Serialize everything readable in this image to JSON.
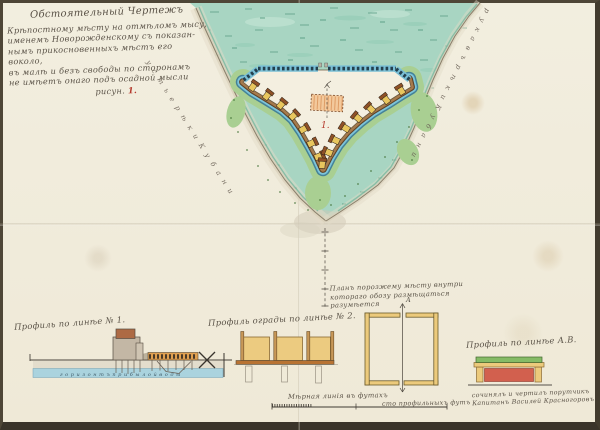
{
  "palette": {
    "paper": "#f2eedf",
    "sea": "#a8d5c2",
    "moat_blue": "#7cc4da",
    "rampart_brown": "#a67a4c",
    "bastion_yellow": "#e8c65e",
    "plan_hatch_fill": "#f3c99c",
    "shore_green": "#a9cf92",
    "ink_sepia": "#5b5348",
    "ink_red": "#b5392c"
  },
  "title_block": {
    "lines": [
      "Обстоятельный Чертежъ",
      "Крѣпостному мѣсту на отмѣломъ мысу,",
      "именемъ Новорожденскому съ показан-",
      "нымъ прикосновенныхъ мѣстъ его воколо,",
      "въ малѣ и безъ свободы по сторонамъ",
      "не имѣетъ онаго подъ осадной мысли"
    ],
    "figure_word": "рисун.",
    "figure_number": "1."
  },
  "map": {
    "left_coast_text": "у с т ь е  р ѣ к и  К у б а н и",
    "right_coast_text": "р у к а в ъ  р ѣ к и  К у б а н и",
    "fort_number_label": "1.",
    "section_letter": "А"
  },
  "plan_note": {
    "line1": "Планъ порозжему мѣсту внутри",
    "line2": "котораго обозу размѣщаться разумѣется"
  },
  "profiles": {
    "p1_label": "Профиль по линѣе № 1.",
    "p1_water_text": "г о р и з о н т ъ   п р и б ы л о й   в о д ы",
    "p2_label": "Профиль ограды по линѣе № 2.",
    "ab_label": "Профиль по линѣе А.В."
  },
  "scale_bar": {
    "label": "Мѣрная линія въ футахъ",
    "right_text": "сто профильныхъ футъ"
  },
  "signature": {
    "line1": "сочинялъ и чертилъ порутчикъ",
    "line2": "Капитанъ Василей Красногоровъ"
  }
}
